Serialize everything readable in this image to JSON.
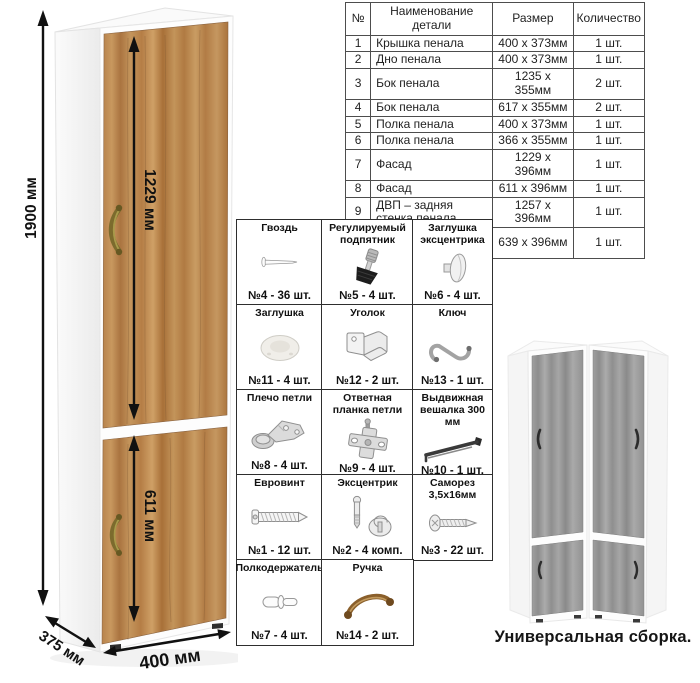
{
  "dimensions": {
    "height": "1900 мм",
    "top_door": "1229 мм",
    "bottom_door": "611 мм",
    "width": "400 мм",
    "depth": "375 мм"
  },
  "parts_table": {
    "headers": [
      "№",
      "Наименование детали",
      "Размер",
      "Количество"
    ],
    "rows": [
      [
        "1",
        "Крышка пенала",
        "400 х 373мм",
        "1 шт."
      ],
      [
        "2",
        "Дно пенала",
        "400 х 373мм",
        "1 шт."
      ],
      [
        "3",
        "Бок пенала",
        "1235 х 355мм",
        "2 шт."
      ],
      [
        "4",
        "Бок пенала",
        "617 х 355мм",
        "2 шт."
      ],
      [
        "5",
        "Полка пенала",
        "400 х 373мм",
        "1 шт."
      ],
      [
        "6",
        "Полка пенала",
        "366 х 355мм",
        "1 шт."
      ],
      [
        "7",
        "Фасад",
        "1229 х 396мм",
        "1 шт."
      ],
      [
        "8",
        "Фасад",
        "611 х 396мм",
        "1 шт."
      ],
      [
        "9",
        "ДВП – задняя стенка пенала",
        "1257 х 396мм",
        "1 шт."
      ],
      [
        "10",
        "ДВП – задняя стенка пенала",
        "639 х 396мм",
        "1 шт."
      ]
    ]
  },
  "hardware": {
    "items": [
      {
        "name": "Гвоздь",
        "count": "№4 - 36 шт.",
        "icon": "nail-icon"
      },
      {
        "name": "Регулируемый подпятник",
        "count": "№5 - 4 шт.",
        "icon": "adjustable-foot-icon"
      },
      {
        "name": "Заглушка эксцентрика",
        "count": "№6 - 4 шт.",
        "icon": "cam-cover-icon"
      },
      {
        "name": "Заглушка",
        "count": "№11 - 4 шт.",
        "icon": "plug-cap-icon"
      },
      {
        "name": "Уголок",
        "count": "№12 - 2 шт.",
        "icon": "corner-bracket-icon"
      },
      {
        "name": "Ключ",
        "count": "№13 - 1 шт.",
        "icon": "hex-key-icon"
      },
      {
        "name": "Плечо петли",
        "count": "№8 - 4 шт.",
        "icon": "hinge-arm-icon"
      },
      {
        "name": "Ответная планка петли",
        "count": "№9 - 4 шт.",
        "icon": "hinge-plate-icon"
      },
      {
        "name": "Выдвижная вешалка 300 мм",
        "count": "№10 - 1 шт.",
        "icon": "pullout-hanger-icon"
      },
      {
        "name": "Евровинт",
        "count": "№1 - 12 шт.",
        "icon": "euro-screw-icon"
      },
      {
        "name": "Эксцентрик",
        "count": "№2 - 4 комп.",
        "icon": "cam-lock-icon"
      },
      {
        "name": "Саморез 3,5х16мм",
        "count": "№3 - 22 шт.",
        "icon": "self-tapping-screw-icon"
      },
      {
        "name": "Полкодержатель",
        "count": "№7 - 4 шт.",
        "icon": "shelf-pin-icon"
      },
      {
        "name": "Ручка",
        "count": "№14 - 2 шт.",
        "icon": "handle-icon"
      }
    ]
  },
  "footer": {
    "caption": "Универсальная сборка."
  },
  "colors": {
    "wood": "#bc8a52",
    "wood_dark": "#a1703c",
    "gray_wood": "#9a9a9a",
    "carcass": "#fdfdfd",
    "ink": "#111111"
  }
}
